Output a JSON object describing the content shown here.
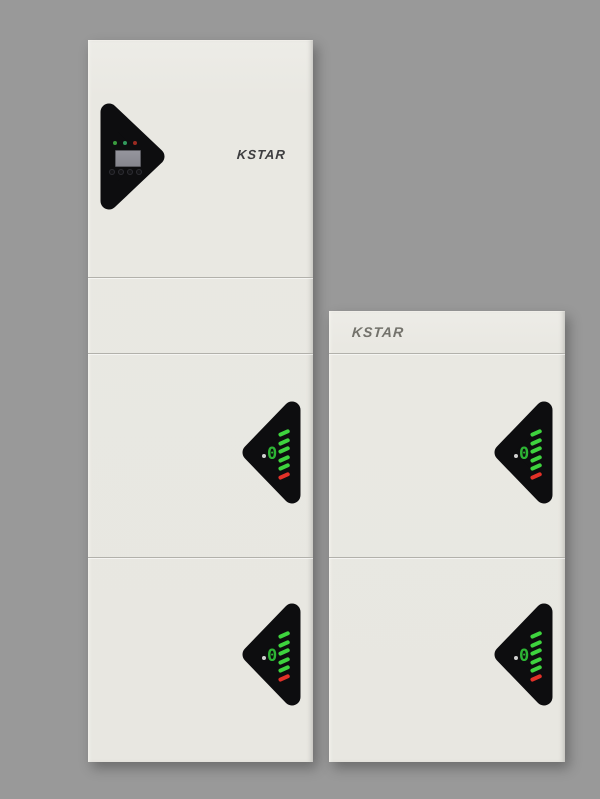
{
  "background_color": "#999999",
  "left_tower": {
    "brand_label": "KSTAR",
    "brand_color": "#3e3e40",
    "inverter": {
      "status_leds": [
        {
          "name": "led-green-1",
          "color": "#3a9c3e"
        },
        {
          "name": "led-green-2",
          "color": "#31995c"
        },
        {
          "name": "led-red",
          "color": "#9c2a21"
        }
      ],
      "button_count": 4
    }
  },
  "right_tower": {
    "brand_label": "KSTAR",
    "brand_color": "#73726b"
  },
  "battery_indicator": {
    "digit": "0",
    "digit_color": "#2db434",
    "dot_color": "#d0d0d0",
    "bars": [
      "#3ed33e",
      "#3ed33e",
      "#3ed33e",
      "#3ed33e",
      "#3ed33e",
      "#e33128"
    ]
  },
  "colors": {
    "cabinet": "#e9e8e2",
    "panel_black": "#0d0d0f",
    "lcd_screen": "#8c8c94",
    "divider": "#b2b1ab"
  }
}
